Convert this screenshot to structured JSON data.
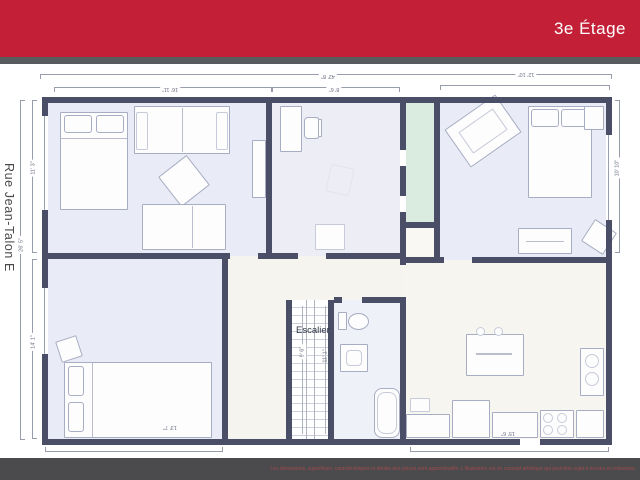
{
  "header": {
    "title": "3e Étage",
    "accent_color": "#c32038"
  },
  "street_label": "Rue Jean-Talon E",
  "plan": {
    "stairs_label": "Escalier",
    "dimensions": {
      "top_total": "42' 8\"",
      "top_left": "16' 11\"",
      "top_middle": "8' 6\"",
      "top_right": "12' 10\"",
      "left_upper": "11' 3\"",
      "left_total": "26' 5\"",
      "left_lower": "14' 1\"",
      "right_upper": "10' 10\"",
      "stairs_inner": "9' 6\"",
      "stairs_outer": "11' 1\"",
      "bedroom_bottom": "13' 7\"",
      "kitchen_bottom": "15' 6\""
    },
    "colors": {
      "wall": "#4a4e66",
      "floor_lavender": "#e9ecf6",
      "corridor_green": "#d9ecdf",
      "floor_warm_white": "#f7f5f0"
    }
  },
  "footer": {
    "disclaimer": "Les dimensions, superficies, caractéristiques et détails des pièces sont approximatifs. L'illustration est un concept artistique qui peut être sujet à erreurs et omissions."
  }
}
